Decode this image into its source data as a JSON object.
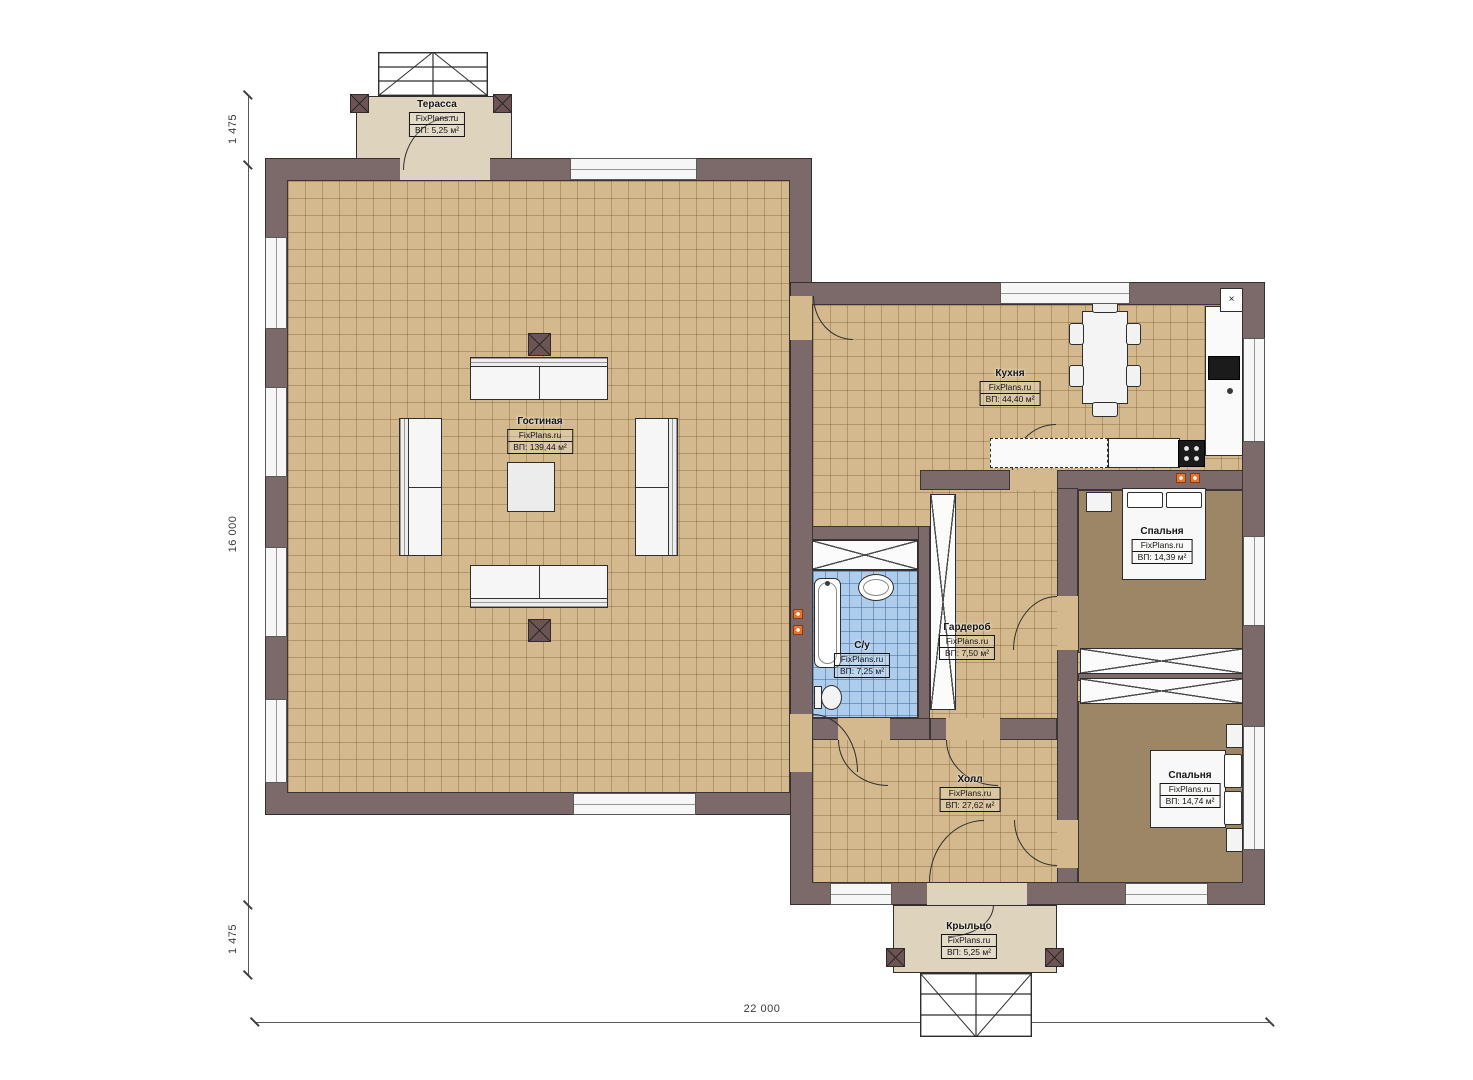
{
  "plan": {
    "brand": "FixPlans.ru",
    "rooms": {
      "terrace": {
        "name": "Терасса",
        "area": "ВП: 5,25 м²"
      },
      "living": {
        "name": "Гостиная",
        "area": "ВП: 139,44 м²"
      },
      "kitchen": {
        "name": "Кухня",
        "area": "ВП: 44,40 м²"
      },
      "bathroom": {
        "name": "С/у",
        "area": "ВП: 7,25 м²"
      },
      "wardrobe": {
        "name": "Гардероб",
        "area": "ВП: 7,50 м²"
      },
      "bedroom1": {
        "name": "Спальня",
        "area": "ВП: 14,39 м²"
      },
      "bedroom2": {
        "name": "Спальня",
        "area": "ВП: 14,74 м²"
      },
      "hall": {
        "name": "Холл",
        "area": "ВП: 27,62 м²"
      },
      "porch": {
        "name": "Крыльцо",
        "area": "ВП: 5,25 м²"
      }
    },
    "dimensions": {
      "left_top": "1 475",
      "left_main": "16 000",
      "left_bottom": "1 475",
      "bottom_total": "22 000"
    },
    "symbols": {
      "vent": "×"
    },
    "colors": {
      "wall": "#7c6969",
      "floor_tile": "#d3b98d",
      "bedroom_floor": "#9c8666",
      "bathroom_tile": "#aecdec",
      "deck": "#ded3bc",
      "marker_orange": "#e8722f"
    }
  }
}
